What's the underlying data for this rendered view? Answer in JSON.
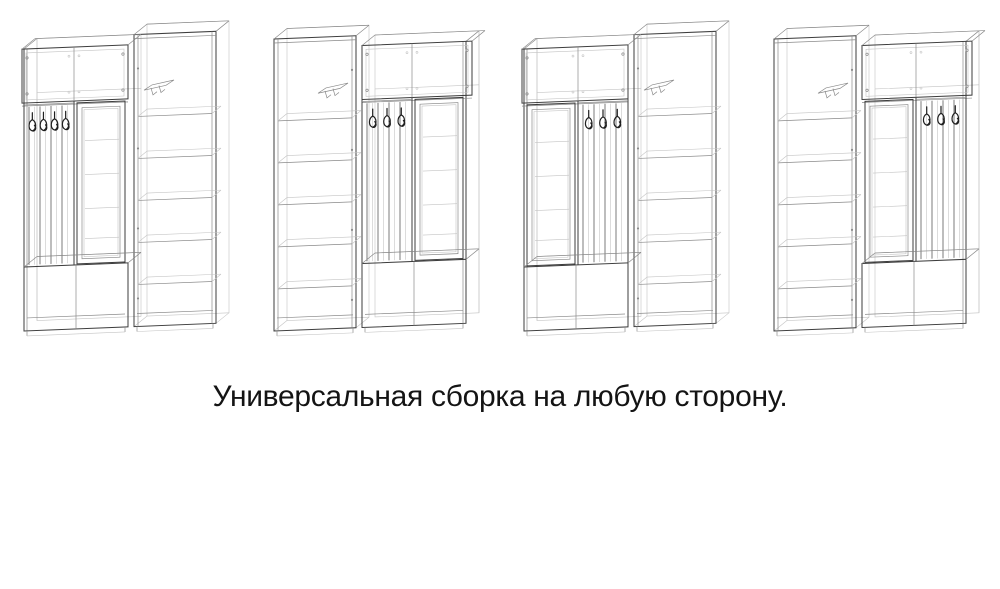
{
  "caption": {
    "text": "Универсальная сборка на любую сторону.",
    "color": "#141414"
  },
  "drawing": {
    "colors": {
      "background": "#ffffff",
      "main": "#3d3d3d",
      "soft": "#8a8a8a",
      "faint": "#c4c4c4",
      "slat": "#5a5a5a",
      "dark": "#1f1f1f"
    },
    "elements": {
      "wardrobe": "tall-shelf-cabinet",
      "hooks": "coat-hook-panel",
      "mirror": "framed-mirror",
      "top_cabinet": "overhead-cabinet",
      "bench": "shoe-bench"
    },
    "variants": [
      {
        "label": "variant-1",
        "order": [
          "hooks",
          "mirror",
          "wardrobe"
        ],
        "hook_count": 4
      },
      {
        "label": "variant-2",
        "order": [
          "wardrobe",
          "hooks",
          "mirror"
        ],
        "hook_count": 3
      },
      {
        "label": "variant-3",
        "order": [
          "mirror",
          "hooks",
          "wardrobe"
        ],
        "hook_count": 3
      },
      {
        "label": "variant-4",
        "order": [
          "wardrobe",
          "mirror",
          "hooks"
        ],
        "hook_count": 3
      }
    ]
  }
}
